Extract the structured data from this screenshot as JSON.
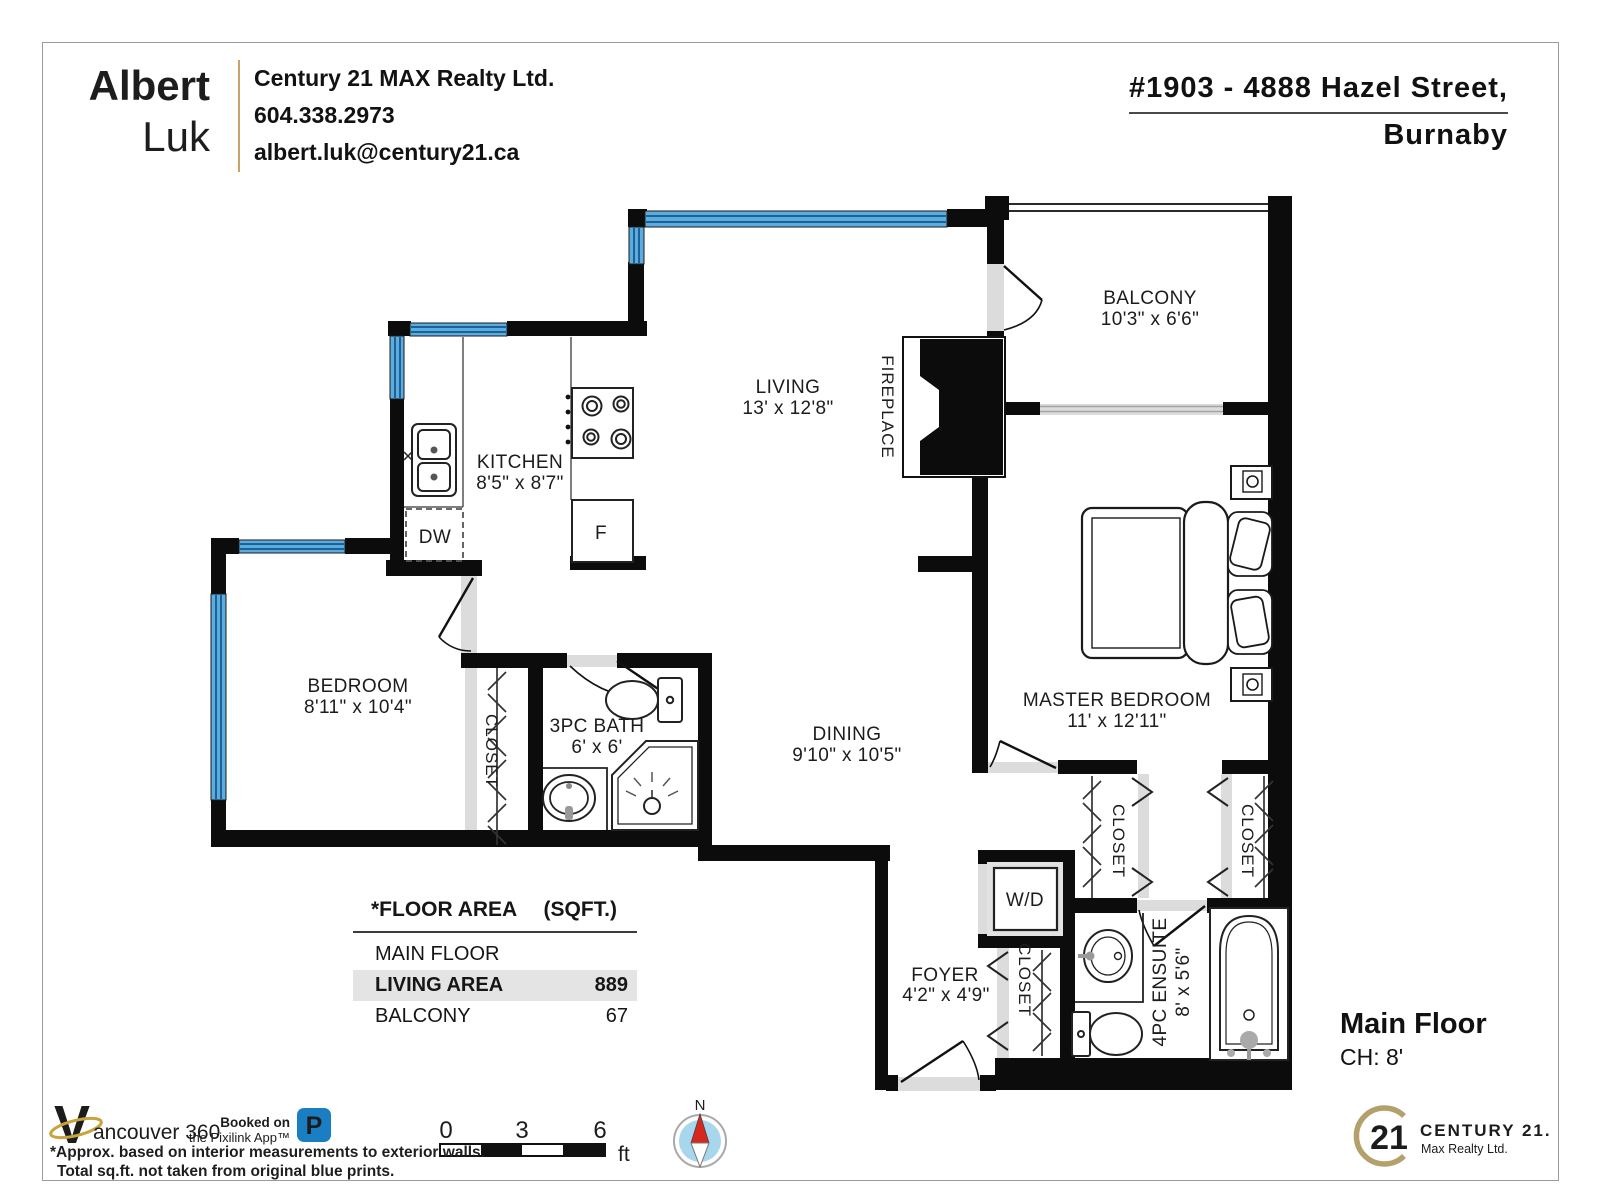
{
  "header": {
    "agent_first": "Albert",
    "agent_last": "Luk",
    "brokerage": "Century 21 MAX Realty Ltd.",
    "phone": "604.338.2973",
    "email": "albert.luk@century21.ca",
    "address_line1": "#1903 - 4888 Hazel Street,",
    "address_line2": "Burnaby"
  },
  "rooms": {
    "balcony": {
      "name": "BALCONY",
      "dims": "10'3\" x 6'6\""
    },
    "living": {
      "name": "LIVING",
      "dims": "13' x 12'8\""
    },
    "fireplace": "FIREPLACE",
    "kitchen": {
      "name": "KITCHEN",
      "dims": "8'5\" x 8'7\""
    },
    "bedroom": {
      "name": "BEDROOM",
      "dims": "8'11\" x 10'4\""
    },
    "bath": {
      "name": "3PC BATH",
      "dims": "6' x 6'"
    },
    "dining": {
      "name": "DINING",
      "dims": "9'10\" x 10'5\""
    },
    "master": {
      "name": "MASTER BEDROOM",
      "dims": "11' x 12'11\""
    },
    "ensuite": {
      "name": "4PC ENSUITE",
      "dims": "8' x 5'6\""
    },
    "foyer": {
      "name": "FOYER",
      "dims": "4'2\" x 4'9\""
    },
    "closet": "CLOSET",
    "wd": "W/D",
    "dw": "DW",
    "fridge": "F"
  },
  "area_table": {
    "title": "*FLOOR AREA",
    "unit": "(SQFT.)",
    "rows": [
      {
        "label": "MAIN FLOOR",
        "value": ""
      },
      {
        "label": "LIVING AREA",
        "value": "889"
      },
      {
        "label": "BALCONY",
        "value": "67"
      }
    ]
  },
  "floor_label": {
    "title": "Main Floor",
    "ceiling": "CH: 8'"
  },
  "scale_bar": {
    "t0": "0",
    "t1": "3",
    "t2": "6",
    "unit": "ft"
  },
  "compass": {
    "north": "N"
  },
  "footer": {
    "vancouver360_v": "V",
    "vancouver360_text": "ancouver 360",
    "booked_line1": "Booked on",
    "booked_line2": "the Pixilink App™",
    "pixilink_icon": "P",
    "disclaimer_line1": "*Approx. based on interior measurements to exterior walls.",
    "disclaimer_line2": "Total sq.ft. not taken from original blue prints.",
    "c21_number": "21",
    "c21_name": "CENTURY 21.",
    "c21_sub": "Max Realty Ltd."
  },
  "colors": {
    "wall": "#0c0c0c",
    "window_blue": "#5CACDE",
    "window_line": "#1c6298",
    "sill_gray": "#dcdcdc",
    "gold": "#b3a06b",
    "teal": "#2d5f74",
    "pixilink_blue": "#1b7ec2",
    "compass_blue": "#a8d6ed",
    "compass_red": "#d7281d",
    "highlight": "#e4e4e4"
  }
}
